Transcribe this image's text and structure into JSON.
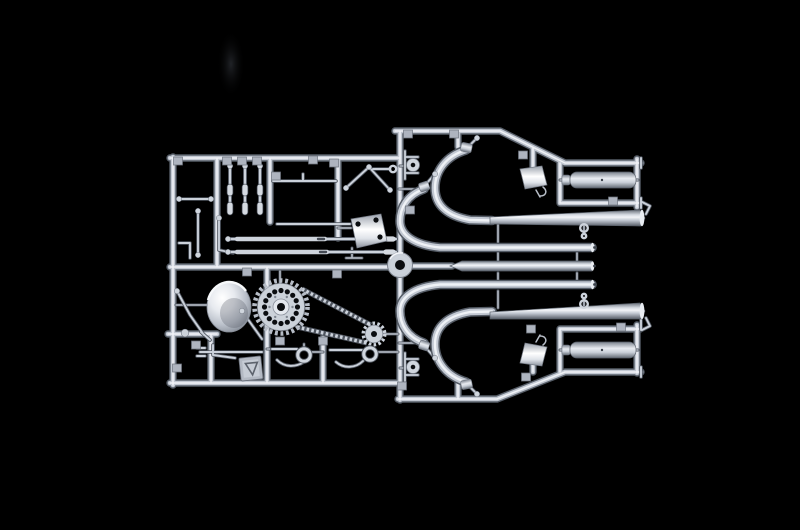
{
  "scene": {
    "type": "photograph",
    "subject": "Silver injection-moulded model kit sprue of motorcycle parts on a black background",
    "description": "A single metallic-grey plastic runner frame (parts tree) photographed on black. The left half holds small parts: a headlamp shell, a drive sprocket with chain and rear sprocket, three fork tubes, long push rods, brake and gear levers, a kick stand, an oil tank and a number plate. The right half holds exhaust components: two large curved header pipes with megaphone silencers, three straight muffler pipes, two cylindrical silencers in sub-frames, mounting brackets and steering hub. Small embossed part-number tags hang throughout the frame."
  },
  "colors": {
    "background": "#000000",
    "plastic_highlight": "#f1f3f7",
    "plastic_light": "#c2c8d2",
    "plastic_mid": "#9aa1ac",
    "plastic_shadow": "#565d67",
    "hole_dark": "#0b0d10"
  },
  "parts": [
    {
      "id": "runner-frame",
      "label": "sprue runner frame"
    },
    {
      "id": "headlamp-shell",
      "label": "headlamp shell"
    },
    {
      "id": "drive-sprocket",
      "label": "drive sprocket with chain"
    },
    {
      "id": "rear-sprocket",
      "label": "rear chain sprocket"
    },
    {
      "id": "fork-tubes",
      "label": "front fork tubes (3)"
    },
    {
      "id": "push-rods",
      "label": "push rods (2)"
    },
    {
      "id": "exhaust-headers",
      "label": "curved exhaust header pipes (4)"
    },
    {
      "id": "megaphone-silencers",
      "label": "megaphone silencers (2)"
    },
    {
      "id": "muffler-pipes",
      "label": "straight muffler pipes (3)"
    },
    {
      "id": "cylindrical-silencers",
      "label": "cylindrical silencers in sub-frames (2)"
    },
    {
      "id": "oil-tank",
      "label": "oil tank"
    },
    {
      "id": "mount-boxes",
      "label": "white mounting boxes (2)"
    },
    {
      "id": "brake-levers",
      "label": "brake / gear levers (2)"
    },
    {
      "id": "kick-stand",
      "label": "kick stand"
    },
    {
      "id": "steering-hub",
      "label": "steering stem hub"
    },
    {
      "id": "fork-yokes",
      "label": "fork yoke brackets (2)"
    },
    {
      "id": "number-plate",
      "label": "number plate with emblem"
    },
    {
      "id": "part-number-tags",
      "label": "embossed part-number tags"
    }
  ]
}
